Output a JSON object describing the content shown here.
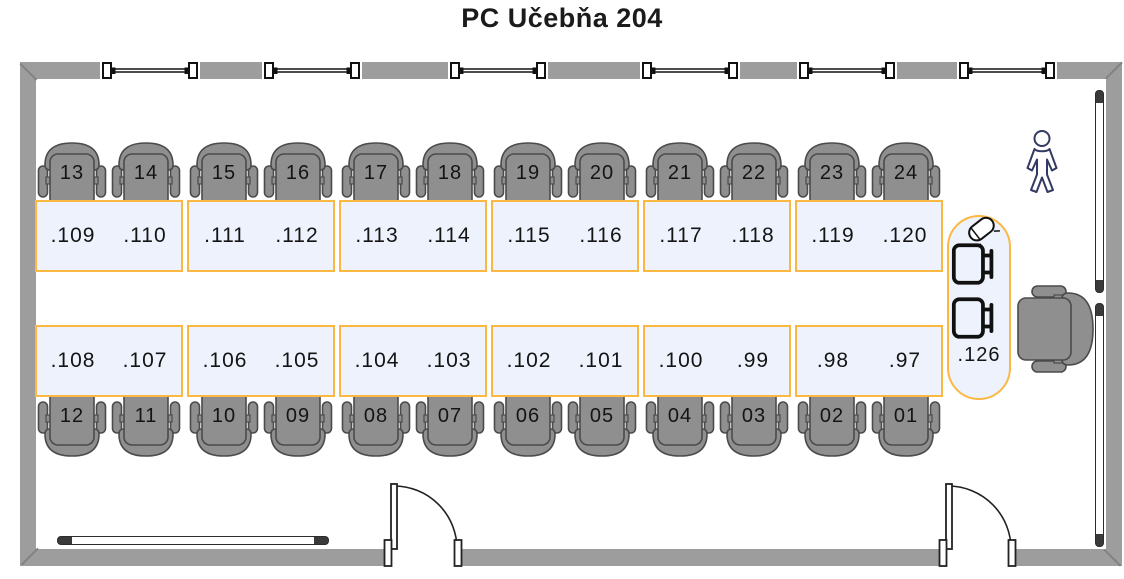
{
  "title": "PC Učebňa 204",
  "classroom": {
    "top_row": {
      "chairs": [
        "13",
        "14",
        "15",
        "16",
        "17",
        "18",
        "19",
        "20",
        "21",
        "22",
        "23",
        "24"
      ],
      "desk_pairs": [
        [
          ".109",
          ".110"
        ],
        [
          ".111",
          ".112"
        ],
        [
          ".113",
          ".114"
        ],
        [
          ".115",
          ".116"
        ],
        [
          ".117",
          ".118"
        ],
        [
          ".119",
          ".120"
        ]
      ]
    },
    "bottom_row": {
      "desk_pairs": [
        [
          ".108",
          ".107"
        ],
        [
          ".106",
          ".105"
        ],
        [
          ".104",
          ".103"
        ],
        [
          ".102",
          ".101"
        ],
        [
          ".100",
          ".99"
        ],
        [
          ".98",
          ".97"
        ]
      ],
      "chairs": [
        "12",
        "11",
        "10",
        "09",
        "08",
        "07",
        "06",
        "05",
        "04",
        "03",
        "02",
        "01"
      ]
    },
    "teacher_station": {
      "label": ".126",
      "computers": 2
    },
    "windows_count": 6,
    "doors_count": 2,
    "radiators_count": 3
  },
  "icons": {
    "person": "person-icon",
    "projector": "projector-icon",
    "computer": "computer-icon"
  },
  "colors": {
    "wall": "#9d9d9d",
    "chair_fill": "#8f8f8f",
    "chair_stroke": "#4b4b4b",
    "desk_fill": "#edf2fc",
    "desk_border": "#fbb843",
    "figure_outline": "#333a63",
    "icon_ink": "#111111",
    "text": "#141414"
  }
}
